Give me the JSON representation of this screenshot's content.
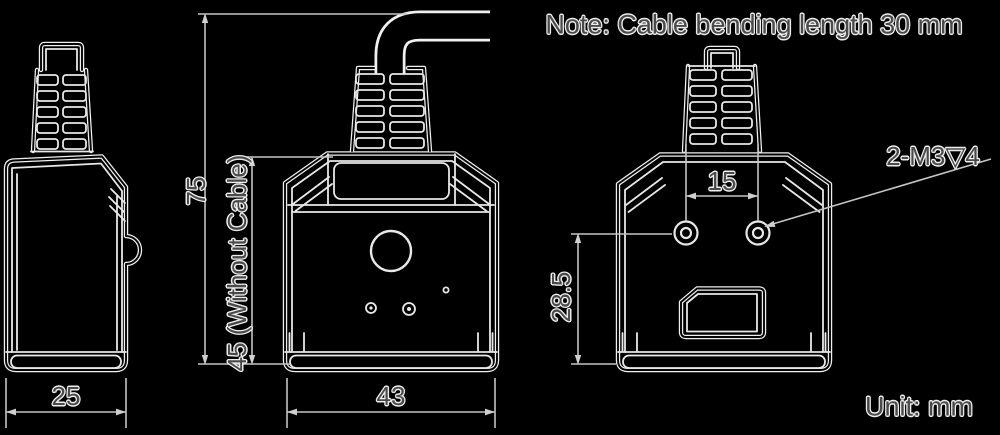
{
  "drawing": {
    "note": "Note: Cable bending length 30 mm",
    "unit": "Unit: mm",
    "dims": {
      "total_height": "75",
      "body_height": "45 (Without Cable)",
      "side_width": "25",
      "front_width": "43",
      "hole_spacing": "15",
      "hole_offset": "28.5",
      "thread_spec": "2-M3▽4"
    },
    "colors": {
      "background": "#000000",
      "artwork_line": "#f0f0f0",
      "dimension_line": "#c4c4c4",
      "label_text": "#4a4a4a",
      "label_halo": "#ededed"
    }
  }
}
